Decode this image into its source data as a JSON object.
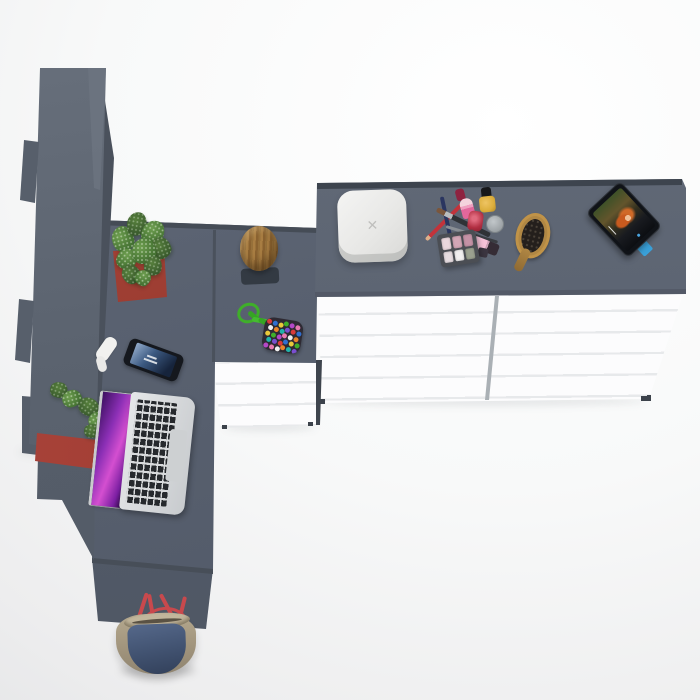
{
  "meta": {
    "description": "Top-down 3D render of an L-shaped grey vanity desk with a tall wardrobe column, white chests of drawers, laptop, phone, cosmetics, hairbrush, tablet playing a movie, cactus, log stool, bead pouch and a handbag",
    "canvas": {
      "width": 700,
      "height": 700
    }
  },
  "palette": {
    "background_light": "#ffffff",
    "background_shade": "#e3e4e6",
    "surface_grey": "#596170",
    "surface_grey_dark": "#4e5663",
    "edge_dark": "#3f4650",
    "drawer_white": "#fcfcfd",
    "drawer_line": "#e7e9eb",
    "planter_red": "#9e3a33",
    "plant_green": "#4c7a38",
    "stool_wood": "#96703a",
    "stool_mat_dark": "#333a43",
    "laptop_silver": "#d8dadc",
    "laptop_key_black": "#26292d",
    "laptop_screen_purple": "#8b2fb5",
    "laptop_screen_magenta": "#d44fd0",
    "phone_body_black": "#15181e",
    "phone_screen_blue": "#3c5a82",
    "accessory_white": "#f1f1ef",
    "box_white": "#eeeeec",
    "box_mark_grey": "#bfbfbd",
    "pencil_red": "#c2333b",
    "pencil_navy": "#2a3560",
    "brush_ferrule_silver": "#b9bcbe",
    "lipstick_pink": "#e2679c",
    "polish_red": "#b12f42",
    "polish_yellow": "#dcae3c",
    "jar_silver": "#9aa0a4",
    "gloss_pink": "#f6c2d8",
    "palette_tray_grey": "#4b4e54",
    "hairbrush_wood": "#b08744",
    "bristle_dark": "#241f1c",
    "tablet_body_black": "#101318",
    "tablet_stand_blue": "#3aa0d8",
    "movie_hair_orange": "#c85a1e",
    "rope_green": "#3fae2a",
    "pouch_dark": "#2e2a33",
    "bag_tan": "#a89b86",
    "bag_denim": "#42536e",
    "bag_strap_red": "#c8494d"
  },
  "jewelry_box": {
    "mark": "✕"
  },
  "eyeshadow_pans": [
    "#ead7dd",
    "#d3a6b6",
    "#c492a6",
    "#e6dce0",
    "#f1eff0",
    "#9aa08f"
  ],
  "bead_colors": [
    "#d93a3a",
    "#2f6fd0",
    "#e8c93a",
    "#3fae2a",
    "#b548c8",
    "#e87ab0",
    "#f0f0f0",
    "#e8842a",
    "#20b2aa",
    "#7a4fd0"
  ],
  "furniture": {
    "wardrobe": {
      "name": "tall wardrobe column"
    },
    "desk": {
      "name": "L-shaped corner desk"
    },
    "dresser": {
      "sections": 2,
      "drawers_per_section": 5
    },
    "corner_unit": {
      "drawers": 3
    }
  }
}
